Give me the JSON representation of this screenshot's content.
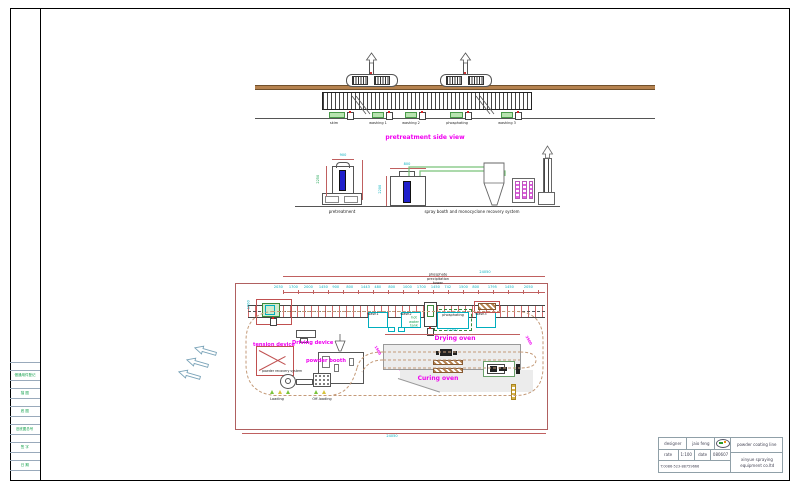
{
  "side_view": {
    "title": "pretreatment side view",
    "tanks": [
      "skim",
      "washing 1",
      "washing 2",
      "phosphating",
      "washing 3"
    ]
  },
  "elevations": {
    "left_label": "pretreatment",
    "right_label": "spray booth and monocyclone recovery system",
    "dims": {
      "left_h": "2250",
      "left_top": "900",
      "booth_h": "2200",
      "booth_top": "800"
    }
  },
  "plan": {
    "tower_lines": [
      "phosphate",
      "precipitation",
      "tower"
    ],
    "overall_dim_top": "24050",
    "overall_dim_bottom": "24050",
    "oven_dim": "22300",
    "left_dim": "1600",
    "diag_dim_right": "3500",
    "diag_dim_booth": "1500",
    "diag_dim_low": "2000",
    "chain_dims": [
      "2030",
      "1700",
      "2000",
      "1450",
      "900",
      "800",
      "1443",
      "480",
      "800",
      "1000",
      "1700",
      "1450",
      "742",
      "1500",
      "800",
      "1795",
      "1450",
      "2050"
    ],
    "stations": {
      "wash1": "wash1",
      "wash2": "wash2",
      "phosphating": "phosphating",
      "wash3": "wash3"
    },
    "hot_water_tank_lines": [
      "hot",
      "water",
      "tank"
    ],
    "labels": {
      "driving_device": "Driving device",
      "tension_device": "tension device",
      "powder_booth": "powder booth",
      "powder_recovery": "powder recovery system",
      "drying_oven": "Drying oven",
      "curing_oven": "Curing oven",
      "loading": "Loading",
      "offloading": "Off-loading"
    }
  },
  "margin_table": {
    "cells": [
      "借通用件登记",
      "描 图",
      "底 图",
      "旧底图总号",
      "签 字",
      "日 期"
    ]
  },
  "title_block": {
    "designer_label": "designer",
    "designer_value": "jaio feng",
    "rate_label": "rate",
    "rate_value": "1:100",
    "date_label": "date",
    "date_value": "080607",
    "phone": "T:0086-523-88759666",
    "project": "powder coating line",
    "company_line1": "xinyue spraying",
    "company_line2": "equipment co.ltd"
  },
  "colors": {
    "magenta": "#f000f0",
    "cyan_dim": "#00aebe",
    "red_line": "#c06060",
    "tank_green": "#b8e4b0",
    "blue_fill": "#2020cc",
    "beam_brown": "#b5824f"
  }
}
